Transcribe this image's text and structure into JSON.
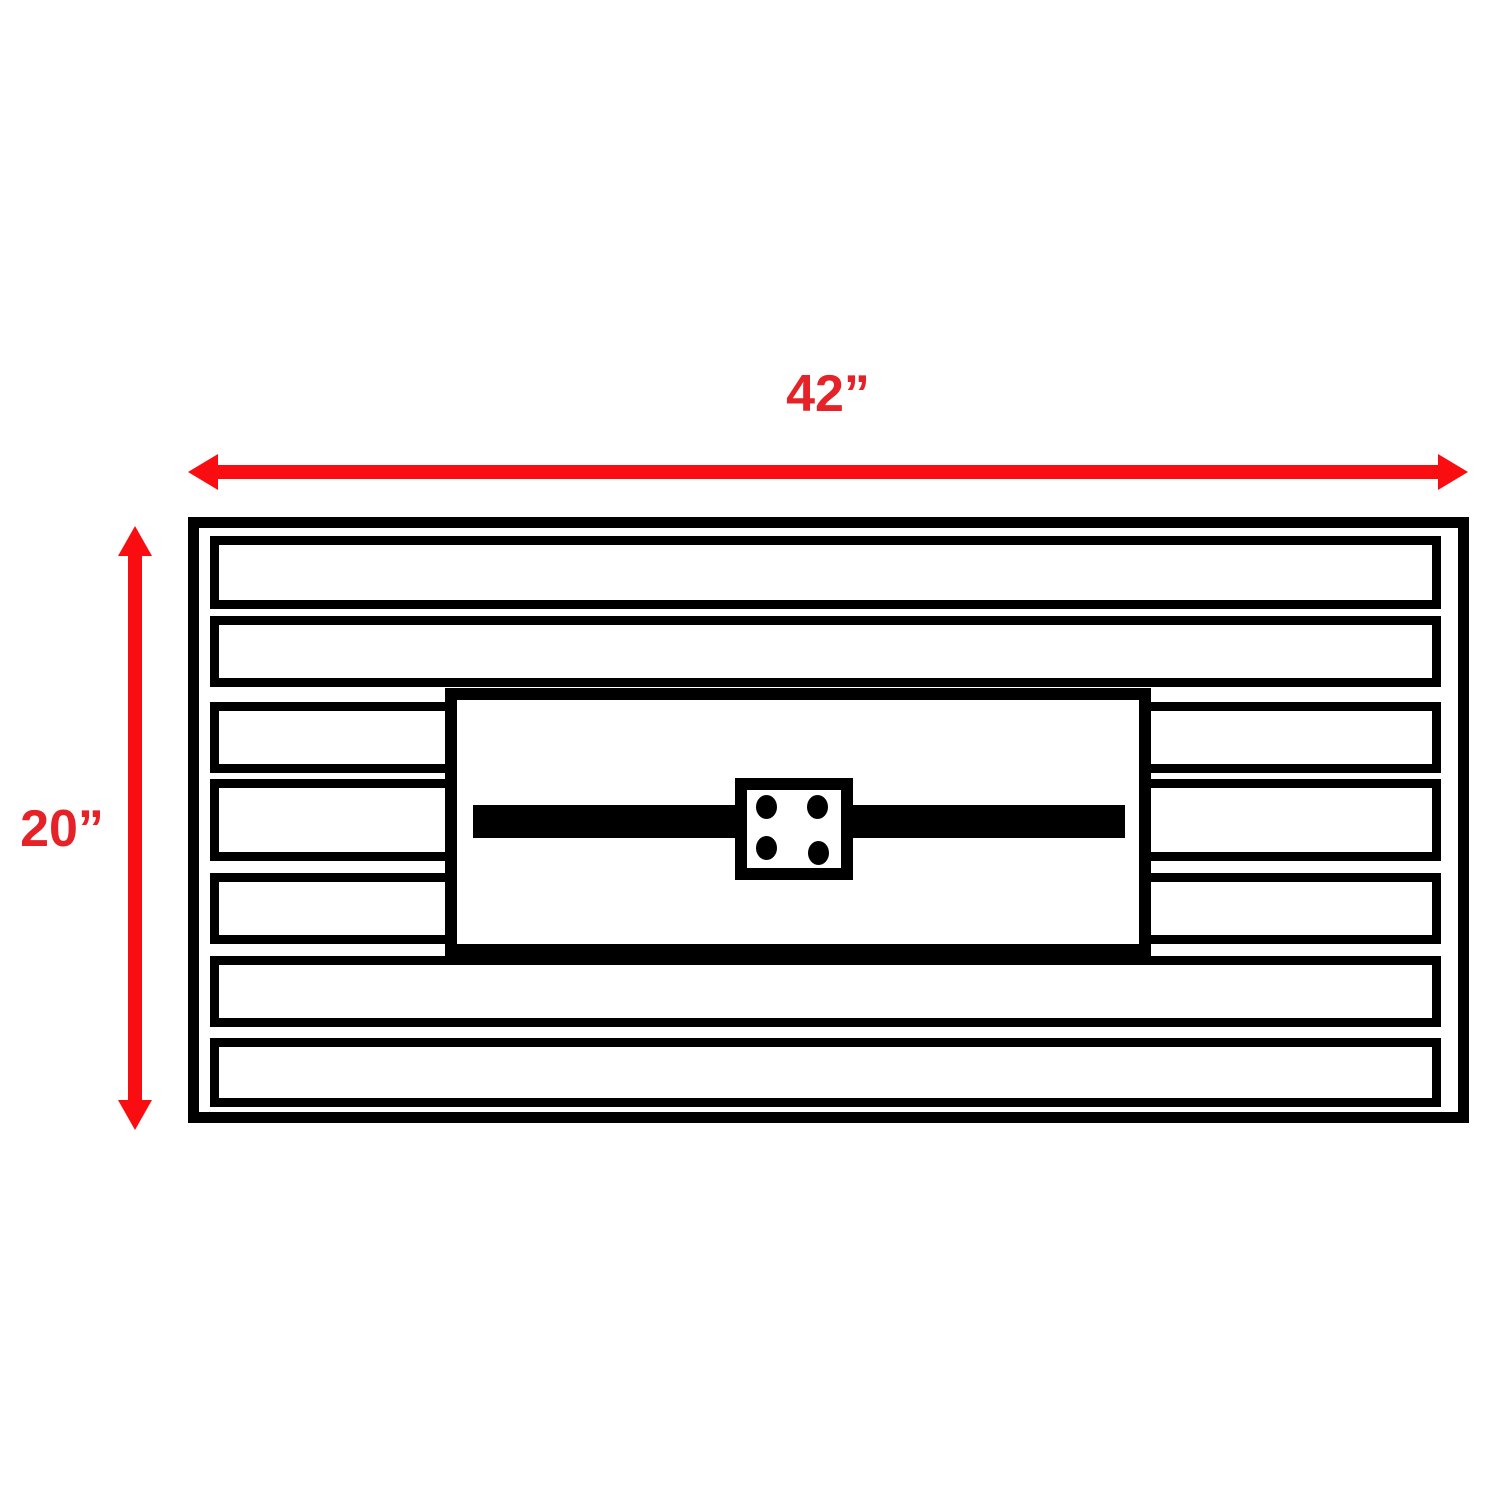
{
  "diagram": {
    "type": "dimension-diagram",
    "width_dimension": {
      "label": "42”"
    },
    "height_dimension": {
      "label": "20”"
    },
    "structure": {
      "slat_rows_total": 7,
      "full_width_rows": [
        1,
        2,
        6,
        7
      ],
      "split_rows": [
        3,
        4,
        5
      ],
      "burner_port_dots": 4
    }
  },
  "colors": {
    "dimension_red": "#e52228",
    "arrow_red": "#f90d10",
    "line_black": "#000000",
    "background": "#ffffff"
  }
}
